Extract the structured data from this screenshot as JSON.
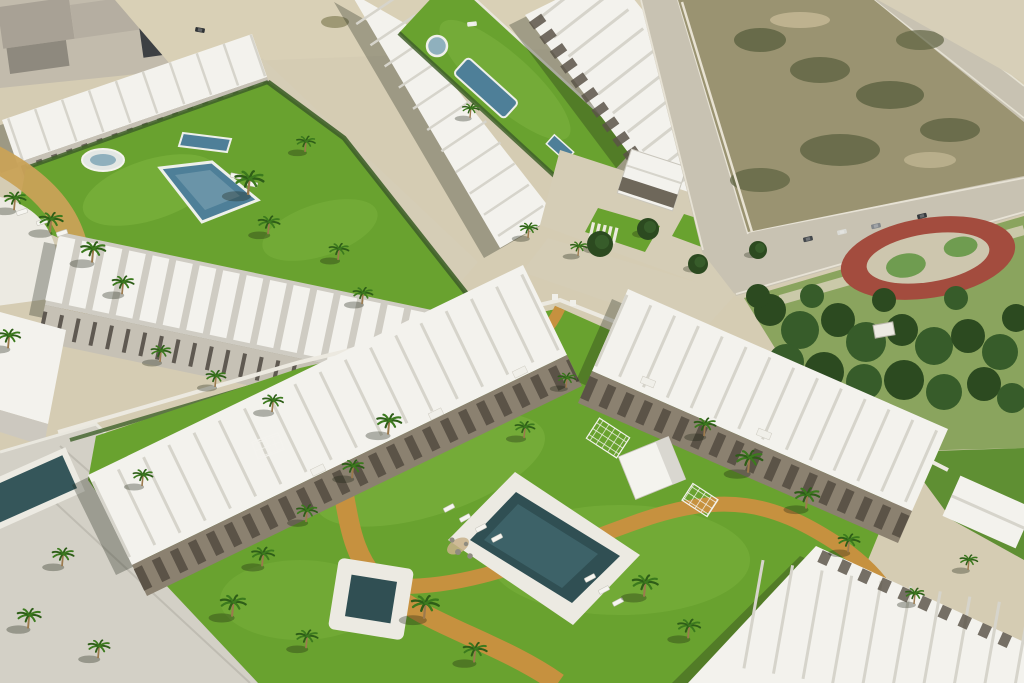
{
  "scene": {
    "label": "Aerial 3D render of a white residential development with lawns, swimming pools, palm trees, a park and roads",
    "scene_type": "aerial-architectural-render",
    "palette": {
      "sand": "#d5ccb3",
      "road": "#c8c2b2",
      "concrete": "#d3d0c6",
      "roofWhite": "#f3f2ed",
      "roofShade": "#d6d4cb",
      "gableShade": "#cfccc3",
      "facade": "#c6c1b5",
      "pergola": "#554e42",
      "terraceBase": "#8b8170",
      "grass": "#69a22f",
      "grassLight": "#85ba45",
      "parkGrass": "#8aa45e",
      "treeDark": "#2c4a20",
      "treeMid": "#375c2a",
      "poolBlue": "#4e7f98",
      "poolDark": "#304f53",
      "poolLight": "#8fb0bd",
      "deck": "#eceae2",
      "pathOrange": "#c6913f",
      "pathTan": "#c9a257",
      "trackRed": "#a34c3e",
      "trackInner": "#cdc6ae",
      "trackGreen": "#6f9c50",
      "scrub": "#9a9371",
      "scrubDark": "#5f6443",
      "wallWhite": "#ece9e0",
      "hedge": "#3f6029",
      "kerb": "#eae6d8",
      "apron": "#d5cdb6",
      "shadow": "rgba(30,36,24,0.30)"
    },
    "palms": [
      [
        14,
        208,
        1.1
      ],
      [
        50,
        230,
        1.2
      ],
      [
        92,
        260,
        1.25
      ],
      [
        122,
        292,
        1.1
      ],
      [
        248,
        192,
        1.45
      ],
      [
        268,
        232,
        1.1
      ],
      [
        305,
        150,
        0.95
      ],
      [
        338,
        258,
        1.0
      ],
      [
        362,
        302,
        1.0
      ],
      [
        160,
        360,
        1.0
      ],
      [
        215,
        385,
        1.0
      ],
      [
        272,
        410,
        1.05
      ],
      [
        8,
        346,
        1.15
      ],
      [
        470,
        116,
        0.85
      ],
      [
        528,
        236,
        0.9
      ],
      [
        578,
        254,
        0.85
      ],
      [
        388,
        432,
        1.25
      ],
      [
        352,
        476,
        1.1
      ],
      [
        306,
        520,
        1.05
      ],
      [
        262,
        564,
        1.15
      ],
      [
        232,
        614,
        1.3
      ],
      [
        306,
        646,
        1.1
      ],
      [
        424,
        616,
        1.4
      ],
      [
        474,
        660,
        1.2
      ],
      [
        524,
        436,
        1.0
      ],
      [
        566,
        386,
        0.9
      ],
      [
        704,
        434,
        1.1
      ],
      [
        748,
        470,
        1.35
      ],
      [
        806,
        506,
        1.25
      ],
      [
        848,
        550,
        1.1
      ],
      [
        644,
        594,
        1.3
      ],
      [
        688,
        636,
        1.15
      ],
      [
        142,
        484,
        1.0
      ],
      [
        62,
        564,
        1.1
      ],
      [
        28,
        626,
        1.2
      ],
      [
        98,
        656,
        1.1
      ],
      [
        914,
        602,
        0.95
      ],
      [
        968,
        568,
        0.9
      ]
    ],
    "loungers": [
      [
        22,
        212,
        -18
      ],
      [
        42,
        222,
        -18
      ],
      [
        62,
        233,
        -18
      ],
      [
        236,
        176,
        12
      ],
      [
        252,
        184,
        12
      ],
      [
        449,
        508,
        -28
      ],
      [
        465,
        518,
        -28
      ],
      [
        481,
        528,
        -28
      ],
      [
        497,
        538,
        -28
      ],
      [
        590,
        578,
        -28
      ],
      [
        604,
        590,
        -28
      ],
      [
        618,
        602,
        -28
      ]
    ],
    "cars": [
      [
        808,
        239,
        -13,
        "#43474b"
      ],
      [
        842,
        232,
        -13,
        "#dadad5"
      ],
      [
        876,
        226,
        -13,
        "#83878b"
      ],
      [
        922,
        216,
        -13,
        "#35393d"
      ],
      [
        472,
        24,
        -6,
        "#ecece7"
      ],
      [
        200,
        30,
        10,
        "#2f3235"
      ]
    ],
    "street_trees": [
      [
        600,
        244,
        13
      ],
      [
        648,
        229,
        11
      ],
      [
        698,
        264,
        10
      ],
      [
        758,
        250,
        9
      ]
    ]
  }
}
